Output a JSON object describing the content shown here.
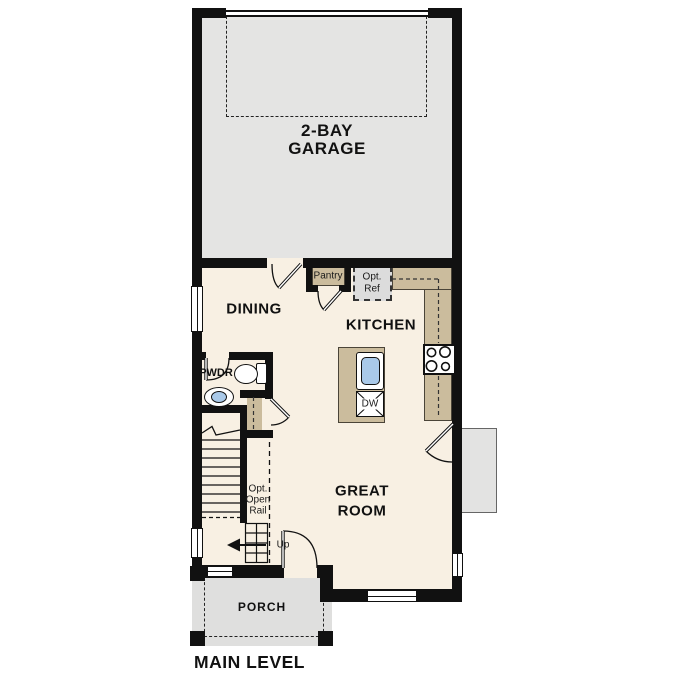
{
  "level": {
    "label": "MAIN LEVEL"
  },
  "rooms": {
    "garage": {
      "line1": "2-BAY",
      "line2": "GARAGE"
    },
    "dining": {
      "label": "DINING"
    },
    "kitchen": {
      "label": "KITCHEN"
    },
    "great_room": {
      "line1": "GREAT",
      "line2": "ROOM"
    },
    "powder": {
      "label": "PWDR"
    },
    "porch": {
      "label": "PORCH"
    }
  },
  "features": {
    "pantry": {
      "label": "Pantry"
    },
    "opt_ref": {
      "line1": "Opt.",
      "line2": "Ref"
    },
    "dishwasher": {
      "label": "DW"
    },
    "stairs": {
      "up": "Up",
      "rail1": "Opt.",
      "rail2": "Open",
      "rail3": "Rail"
    }
  },
  "icons": {
    "kitchen_sink": "sink-icon",
    "range": "stove-burners-icon",
    "toilet": "toilet-icon",
    "powder_sink": "sink-icon",
    "stair_direction": "up-arrow-icon"
  },
  "colors": {
    "wall": "#111111",
    "floor": "#f8f0e3",
    "garage_floor": "#e4e4e3",
    "counter_tan": "#cbbc9d",
    "opt_ref_gray": "#dcdcdc",
    "porch_gray": "#dfdfde",
    "patio_gray": "#e3e3e2",
    "sink_blue": "#a9c9e9"
  }
}
